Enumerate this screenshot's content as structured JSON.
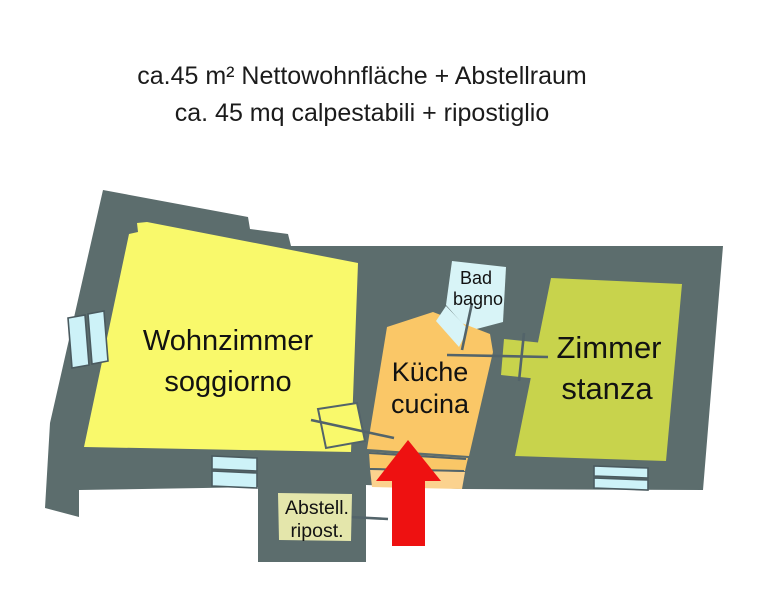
{
  "title": {
    "line1": "ca.45 m² Nettowohnfläche + Abstellraum",
    "line2": "ca. 45 mq calpestabili + ripostiglio"
  },
  "rooms": {
    "wohnzimmer": {
      "label_de": "Wohnzimmer",
      "label_it": "soggiorno",
      "color": "#f9f96b"
    },
    "kueche": {
      "label_de": "Küche",
      "label_it": "cucina",
      "color": "#fac767",
      "entrance_color": "#fbd28e"
    },
    "bad": {
      "label_de": "Bad",
      "label_it": "bagno",
      "color": "#d8f4f7"
    },
    "zimmer": {
      "label_de": "Zimmer",
      "label_it": "stanza",
      "color": "#c8d34c"
    },
    "abstellraum": {
      "label_de": "Abstell.",
      "label_it": "ripost.",
      "color": "#e4e6ab"
    }
  },
  "colors": {
    "wall": "#5c6d6d",
    "window": "#cdf2f8",
    "arrow": "#ee1111",
    "background": "#ffffff"
  }
}
